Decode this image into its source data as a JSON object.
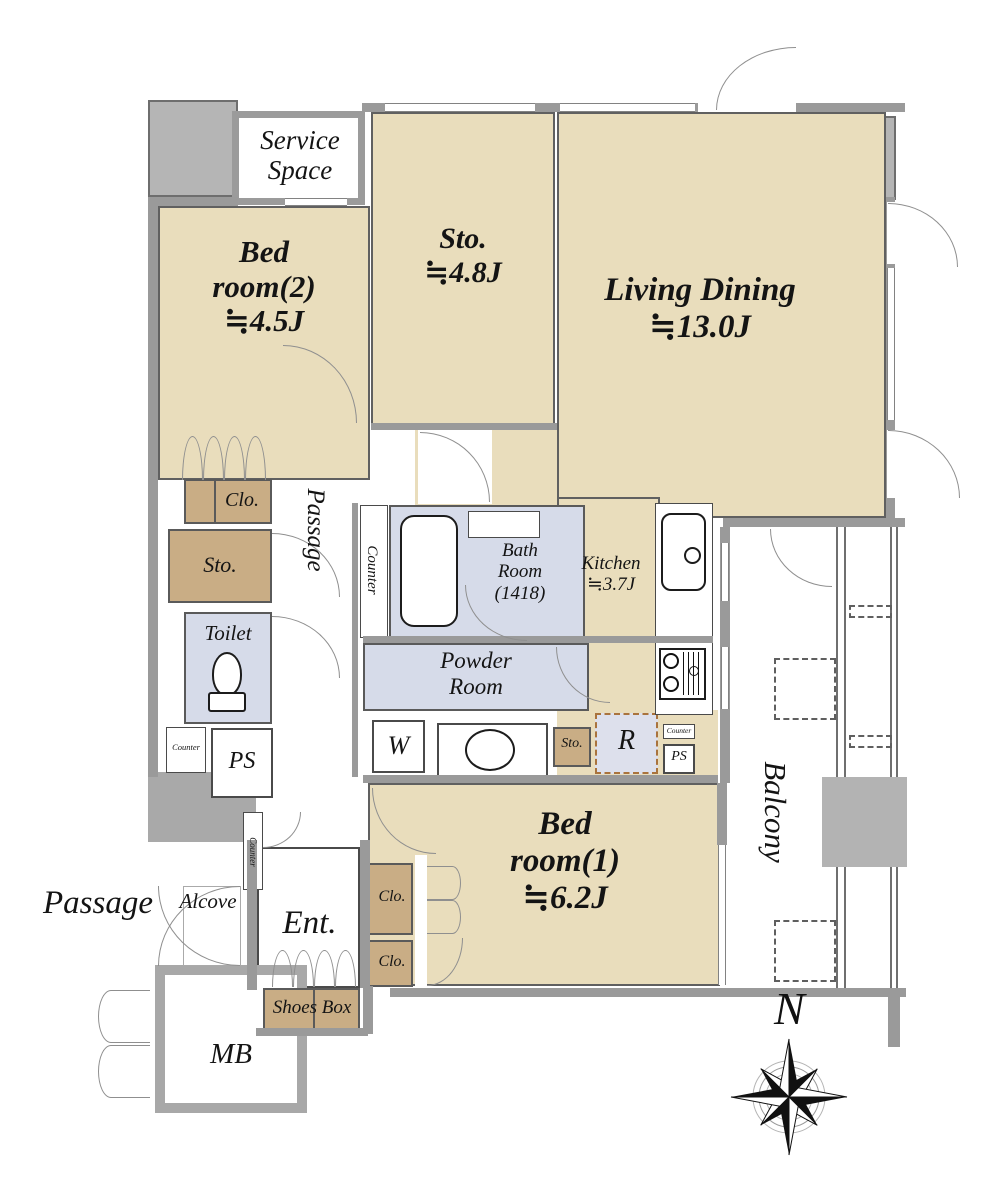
{
  "colors": {
    "room_beige": "#e9ddbc",
    "closet_brown": "#c9ad85",
    "wet_area_lavender": "#d6dbe9",
    "wall_grey": "#9a9a9a",
    "column_grey": "#b5b5b5",
    "line_dark": "#4a4a4a"
  },
  "rooms": {
    "service_space": {
      "line1": "Service",
      "line2": "Space"
    },
    "bedroom2": {
      "line1": "Bed",
      "line2": "room(2)",
      "line3": "≒4.5J"
    },
    "storage_room": {
      "line1": "Sto.",
      "line2": "≒4.8J"
    },
    "living_dining": {
      "line1": "Living Dining",
      "line2": "≒13.0J"
    },
    "kitchen": {
      "line1": "Kitchen",
      "line2": "≒3.7J"
    },
    "bath_room": {
      "line1": "Bath",
      "line2": "Room",
      "line3": "(1418)"
    },
    "powder_room": {
      "line1": "Powder",
      "line2": "Room"
    },
    "toilet": {
      "label": "Toilet"
    },
    "bedroom1": {
      "line1": "Bed",
      "line2": "room(1)",
      "line3": "≒6.2J"
    },
    "balcony": {
      "label": "Balcony"
    },
    "entrance": {
      "label": "Ent."
    },
    "meter_box": {
      "label": "MB"
    },
    "alcove": {
      "label": "Alcove"
    },
    "passage_interior": {
      "label": "Passage"
    },
    "passage_exterior": {
      "label": "Passage"
    },
    "shoes_box": {
      "label": "Shoes Box"
    }
  },
  "fixtures": {
    "closet": "Clo.",
    "storage": "Sto.",
    "counter": "Counter",
    "pipe_shaft": "PS",
    "washer": "W",
    "refrigerator": "R"
  },
  "compass": {
    "north": "N"
  }
}
